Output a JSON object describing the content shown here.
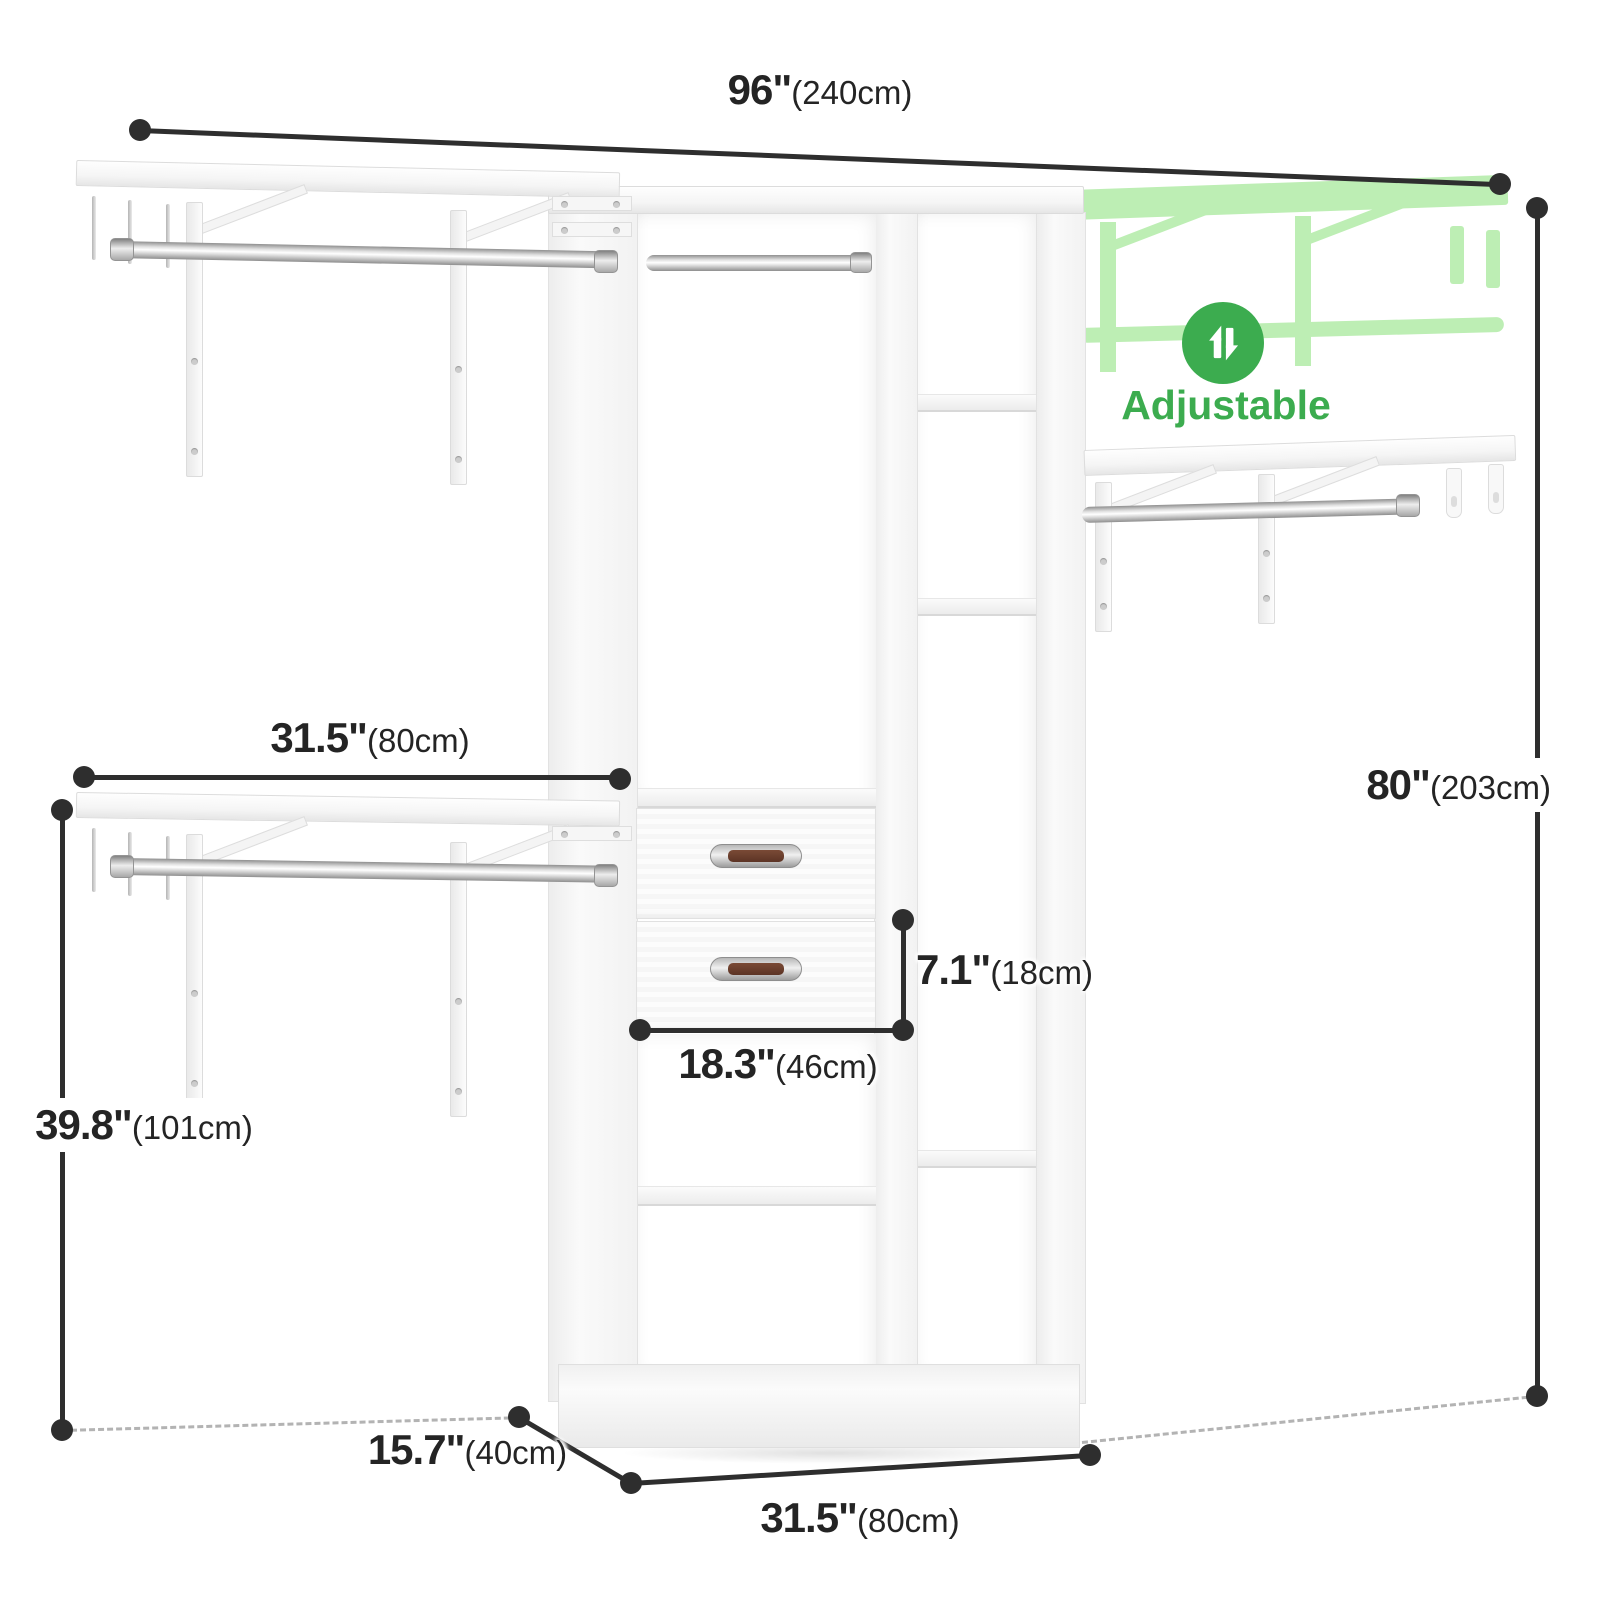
{
  "badge": {
    "label": "Adjustable",
    "icon": "up-down-arrows"
  },
  "dimensions": {
    "overall_width": {
      "value": "96\"",
      "metric": "(240cm)"
    },
    "overall_height": {
      "value": "80\"",
      "metric": "(203cm)"
    },
    "side_shelf_width": {
      "value": "31.5\"",
      "metric": "(80cm)"
    },
    "side_shelf_height": {
      "value": "39.8\"",
      "metric": "(101cm)"
    },
    "drawer_height": {
      "value": "7.1\"",
      "metric": "(18cm)"
    },
    "drawer_width": {
      "value": "18.3\"",
      "metric": "(46cm)"
    },
    "tower_depth": {
      "value": "15.7\"",
      "metric": "(40cm)"
    },
    "tower_width": {
      "value": "31.5\"",
      "metric": "(80cm)"
    }
  },
  "colors": {
    "accent_green": "#3CAC4F",
    "ghost_green": "#BDEEB4",
    "dimension_line": "#2E2E2E",
    "text_dark": "#242424",
    "handle_brown": "#6E4837",
    "metal_silver": "#C9C9C9"
  }
}
